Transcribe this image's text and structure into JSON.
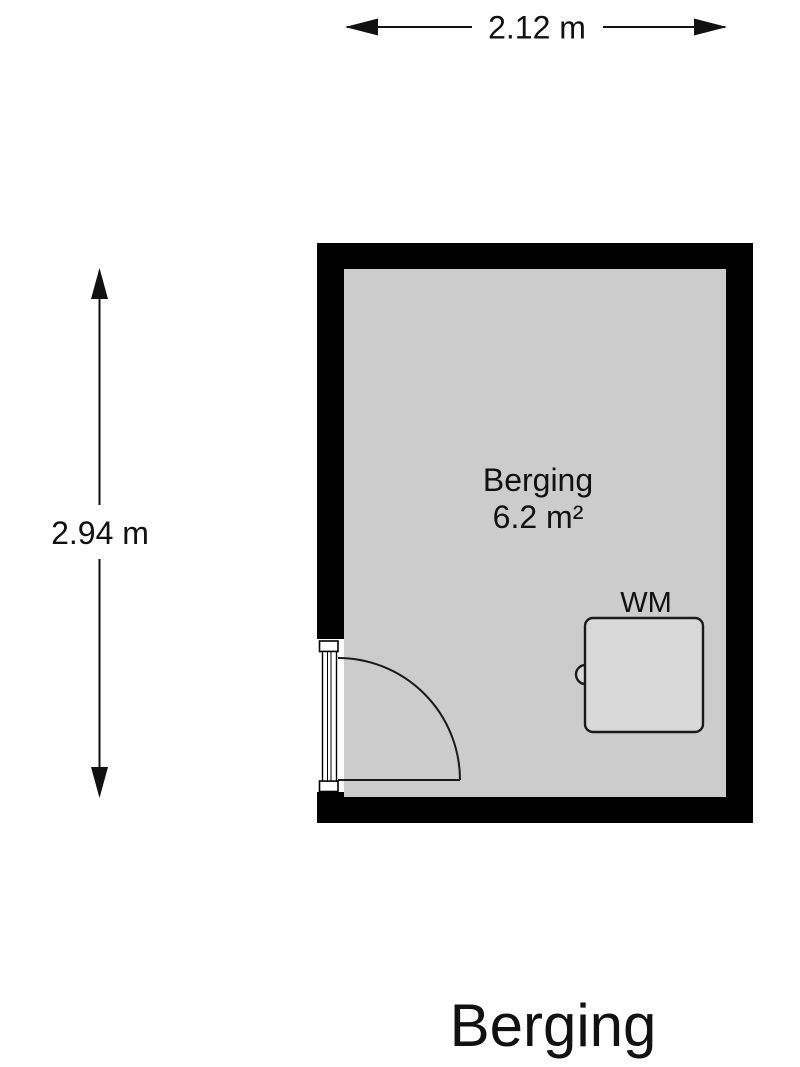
{
  "plan": {
    "title": "Berging",
    "room": {
      "name": "Berging",
      "area": "6.2 m²"
    },
    "dimensions": {
      "width": "2.12 m",
      "height": "2.94 m"
    },
    "appliances": [
      {
        "type": "washing-machine",
        "label": "WM"
      }
    ],
    "colors": {
      "wall": "#000000",
      "floor": "#cccccc",
      "appliance_fill": "#d8d8d8",
      "background": "#ffffff",
      "text": "#111111"
    }
  }
}
